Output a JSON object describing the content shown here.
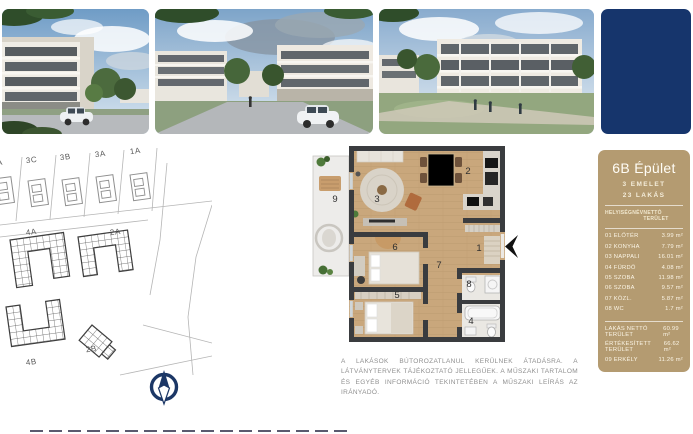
{
  "colors": {
    "navy": "#16356c",
    "gold": "#b49b71",
    "wall": "#3a3c3f",
    "wood": "#c9a77c"
  },
  "panel": {
    "title": "6B Épület",
    "floors": "3 EMELET",
    "units": "23 LAKÁS",
    "table": {
      "col_name": "HELYISÉGNÉV",
      "col_area": "NETTÓ TERÜLET",
      "rows": [
        {
          "name": "01 ELŐTÉR",
          "area": "3.99 m²"
        },
        {
          "name": "02 KONYHA",
          "area": "7.79 m²"
        },
        {
          "name": "03 NAPPALI",
          "area": "16.01 m²"
        },
        {
          "name": "04 FÜRDŐ",
          "area": "4.08 m²"
        },
        {
          "name": "05 SZOBA",
          "area": "11.98 m²"
        },
        {
          "name": "06 SZOBA",
          "area": "9.57 m²"
        },
        {
          "name": "07 KÖZL.",
          "area": "5.87 m²"
        },
        {
          "name": "08 WC",
          "area": "1.7 m²"
        }
      ],
      "summary": [
        {
          "name": "LAKÁS NETTÓ TERÜLET",
          "area": "60.99 m²"
        },
        {
          "name": "ÉRTÉKESÍTETT TERÜLET",
          "area": "66.62 m²"
        },
        {
          "name": "09 ERKÉLY",
          "area": "11.26 m²"
        }
      ]
    }
  },
  "site_plan": {
    "labels": {
      "cut": "A",
      "b3c": "3C",
      "b3b": "3B",
      "b3a": "3A",
      "b1a": "1A",
      "b4a": "4A",
      "b2a": "2A",
      "b2b": "2B",
      "b4b": "4B"
    }
  },
  "floor_plan": {
    "rooms": {
      "r1": "1",
      "r2": "2",
      "r3": "3",
      "r4": "4",
      "r5": "5",
      "r6": "6",
      "r7": "7",
      "r8": "8",
      "r9": "9"
    }
  },
  "disclaimer": "A LAKÁSOK BÚTOROZATLANUL KERÜLNEK ÁTADÁSRA. A LÁTVÁNYTERVEK TÁJÉKOZTATÓ JELLEGŰEK. A MŰSZAKI TARTALOM ÉS EGYÉB INFORMÁCIÓ TEKINTETÉBEN A MŰSZAKI LEÍRÁS AZ IRÁNYADÓ."
}
